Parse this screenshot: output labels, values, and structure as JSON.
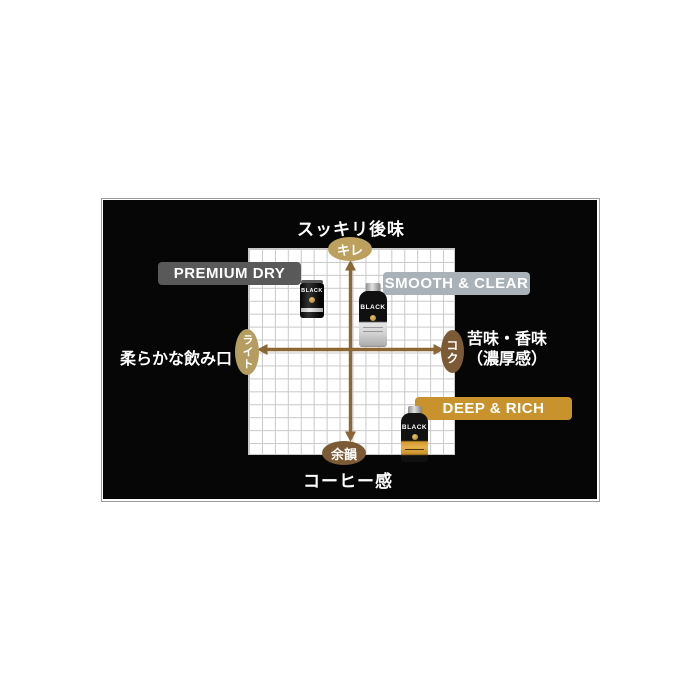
{
  "diagram": {
    "top_axis_label": "スッキリ後味",
    "bottom_axis_label": "コーヒー感",
    "left_axis_label": "柔らかな飲み口",
    "right_axis_label": [
      "苦味・香味",
      "（濃厚感）"
    ],
    "nodes": {
      "top": "キレ",
      "bottom": "余韻",
      "left": "ライト",
      "right": "コク"
    },
    "products": [
      {
        "label": "PREMIUM DRY",
        "badge_color": "#595959",
        "position": "upper-left quadrant (light / kire)"
      },
      {
        "label": "SMOOTH & CLEAR",
        "badge_color": "#a9b1b9",
        "position": "upper-center (kire)"
      },
      {
        "label": "DEEP & RICH",
        "badge_color": "#c8922d",
        "position": "lower-right quadrant (koku / yoin)"
      }
    ],
    "can_brand": "BLACK",
    "colors": {
      "panel_bg": "#060606",
      "axis_arrow": "#8d6636",
      "node_light_fill": "#bda05e",
      "node_dark_fill": "#7c5a36",
      "grid_line": "#c9c9c9",
      "text": "#ffffff"
    }
  }
}
